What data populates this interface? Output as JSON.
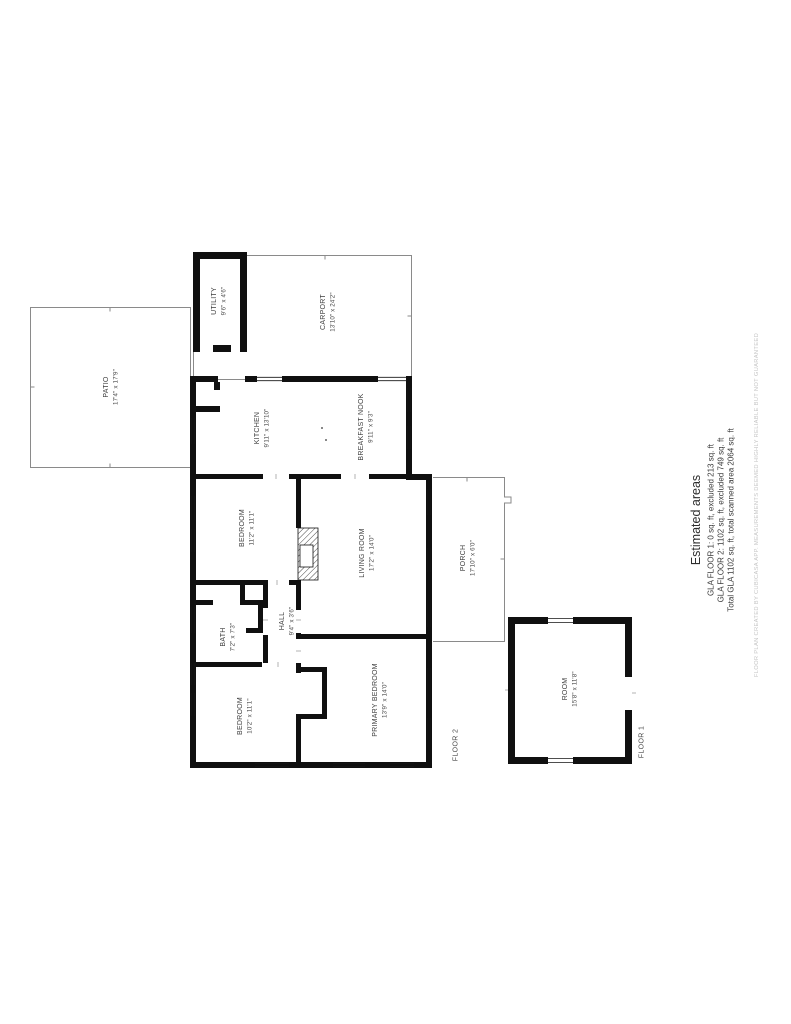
{
  "colors": {
    "background": "#ffffff",
    "walls": "#101010",
    "thin_outline": "#8a8a8a",
    "room_label": "#3d3d3d",
    "disclaimer_text": "#c6c6c6"
  },
  "floorplan": {
    "rooms": [
      {
        "id": "patio",
        "name": "PATIO",
        "dims": "17'4\" x 17'9\""
      },
      {
        "id": "utility",
        "name": "UTILITY",
        "dims": "9'6\" x 4'6\""
      },
      {
        "id": "carport",
        "name": "CARPORT",
        "dims": "13'10\" x 24'2\""
      },
      {
        "id": "kitchen",
        "name": "KITCHEN",
        "dims": "9'11\" x 13'10\""
      },
      {
        "id": "nook",
        "name": "BREAKFAST NOOK",
        "dims": "9'11\" x 9'3\""
      },
      {
        "id": "bedroom1",
        "name": "BEDROOM",
        "dims": "11'2\" x 11'1\""
      },
      {
        "id": "living",
        "name": "LIVING ROOM",
        "dims": "17'2\" x 14'0\""
      },
      {
        "id": "porch",
        "name": "PORCH",
        "dims": "17'10\" x 6'0\""
      },
      {
        "id": "bath",
        "name": "BATH",
        "dims": "7'2\" x 7'3\""
      },
      {
        "id": "hall",
        "name": "HALL",
        "dims": "9'4\" x 3'6\""
      },
      {
        "id": "bedroom2",
        "name": "BEDROOM",
        "dims": "10'2\" x 11'1\""
      },
      {
        "id": "primary",
        "name": "PRIMARY BEDROOM",
        "dims": "13'9\" x 14'0\""
      },
      {
        "id": "room",
        "name": "ROOM",
        "dims": "15'8\" x 11'8\""
      }
    ],
    "floor_labels": [
      {
        "label": "FLOOR 2"
      },
      {
        "label": "FLOOR 1"
      }
    ],
    "estimated_areas": {
      "title": "Estimated areas",
      "lines": [
        "GLA FLOOR 1: 0 sq. ft, excluded 213 sq. ft",
        "GLA FLOOR 2: 1102 sq. ft, excluded 749 sq. ft",
        "Total GLA 1102 sq. ft, total scanned area 2064 sq. ft"
      ]
    },
    "disclaimer": "FLOOR PLAN CREATED BY CUBICASA APP. MEASUREMENTS DEEMED HIGHLY RELIABLE BUT NOT GUARANTEED"
  }
}
